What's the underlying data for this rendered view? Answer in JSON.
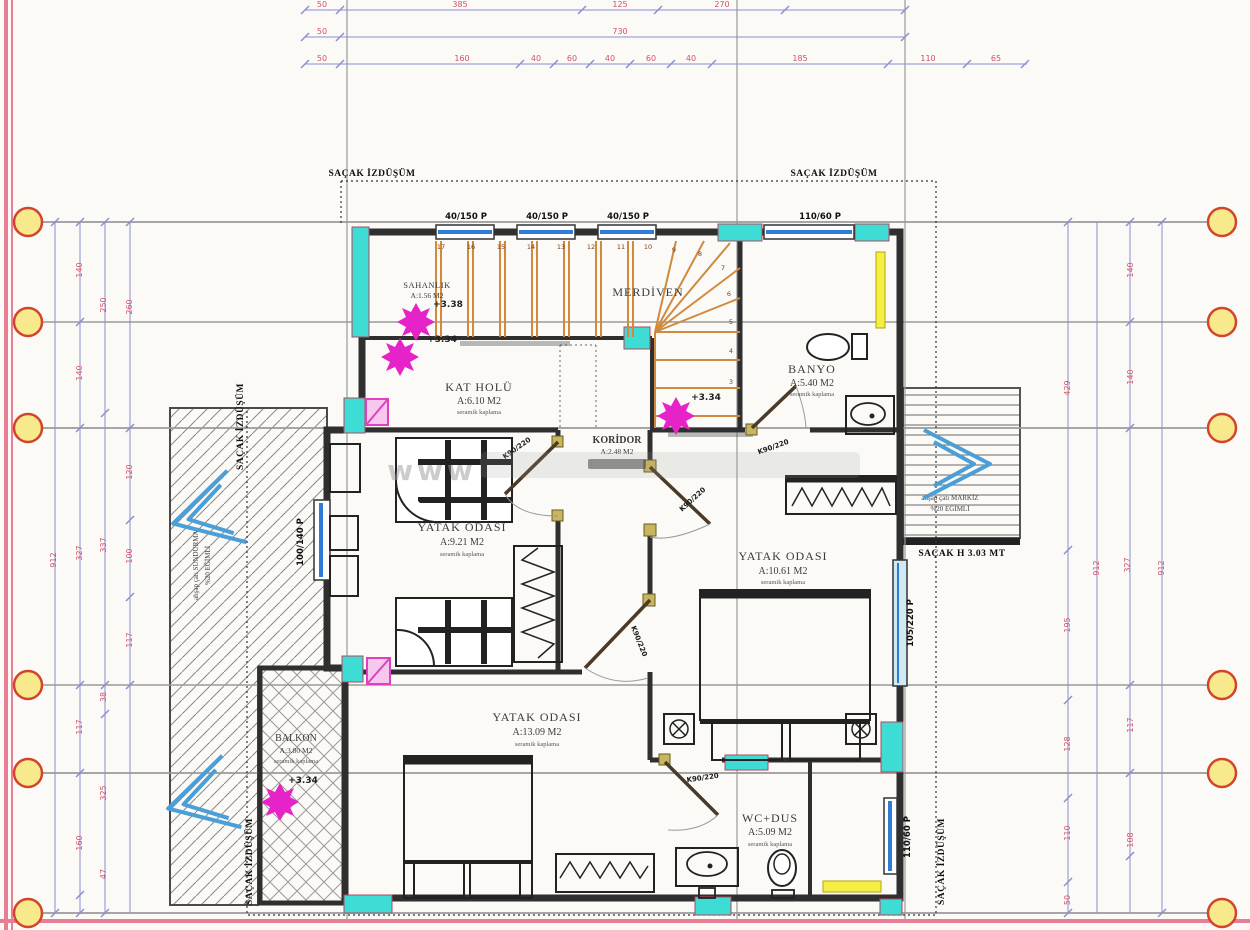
{
  "colors": {
    "frame": "#e87e96",
    "dim_text": "#d4506a",
    "dim_line": "#8b8fd1",
    "grid_line": "#9a9a9a",
    "bubble": "#f7e98c",
    "bubble_ring": "#d2452c",
    "cyan": "#3ddcd4",
    "window": "#2e7cd6",
    "window_pale": "#cfeaf2",
    "stair": "#cf8a3e",
    "magenta": "#e623c8",
    "pink_fill": "#f6c8ee",
    "yellow": "#f3ef44",
    "wall": "#2f2f2f",
    "arrow_blue": "#4a9fd8"
  },
  "dims": {
    "top1": [
      "50",
      "385",
      "125",
      "270"
    ],
    "top2": [
      "50",
      "730"
    ],
    "top3": [
      "50",
      "160",
      "40",
      "60",
      "40",
      "60",
      "40",
      "185",
      "110",
      "65"
    ],
    "left": [
      "140",
      "250",
      "260",
      "140",
      "120",
      "327",
      "337",
      "100",
      "912",
      "117",
      "117",
      "38",
      "325",
      "160",
      "47"
    ],
    "right": [
      "140",
      "429",
      "140",
      "327",
      "912",
      "912",
      "195",
      "117",
      "128",
      "110",
      "108",
      "50"
    ]
  },
  "rooms": {
    "sahanlik": {
      "name": "SAHANLIK",
      "area": "A:1.56 M2"
    },
    "merdiven": {
      "name": "MERDİVEN"
    },
    "kat_holu": {
      "name": "KAT HOLÜ",
      "area": "A:6.10 M2",
      "finish": "seramik kaplama"
    },
    "banyo": {
      "name": "BANYO",
      "area": "A:5.40 M2",
      "finish": "seramik kaplama"
    },
    "koridor": {
      "name": "KORİDOR",
      "area": "A:2.48 M2",
      "finish": "seramik kaplama"
    },
    "yatak1": {
      "name": "YATAK ODASI",
      "area": "A:9.21 M2",
      "finish": "seramik kaplama"
    },
    "yatak2": {
      "name": "YATAK ODASI",
      "area": "A:10.61 M2",
      "finish": "seramik kaplama"
    },
    "yatak3": {
      "name": "YATAK ODASI",
      "area": "A:13.09 M2",
      "finish": "seramik kaplama"
    },
    "balkon": {
      "name": "BALKON",
      "area": "A:3.80 M2",
      "finish": "seramik kaplama"
    },
    "wc": {
      "name": "WC+DUS",
      "area": "A:5.09 M2",
      "finish": "seramik kaplama"
    }
  },
  "levels": {
    "sahanlik_upper": "+3.38",
    "sahanlik_lower": "+3.34",
    "koridor": "+3.34",
    "balkon": "+3.34"
  },
  "windows": {
    "w40": "40/150 P",
    "w110": "110/60 P",
    "w100": "100/140 P",
    "w105": "105/220 P"
  },
  "doors": {
    "k90": "K90/220"
  },
  "stairs": {
    "numbers": [
      "17",
      "16",
      "15",
      "14",
      "13",
      "12",
      "11",
      "10",
      "9",
      "8",
      "7",
      "6",
      "5",
      "4",
      "3"
    ]
  },
  "annotations": {
    "sacak": "SAÇAK İZDÜŞÜM",
    "sundurma_line1": "ahşap çatı SUNDURMA",
    "sundurma_line2": "%20 EĞİMLİ",
    "markiz_line1": "ahşap çatı MARKİZ",
    "markiz_line2": "%20 EĞİMLİ",
    "sacak_height": "SAÇAK H 3.03 MT",
    "watermark": "www"
  }
}
